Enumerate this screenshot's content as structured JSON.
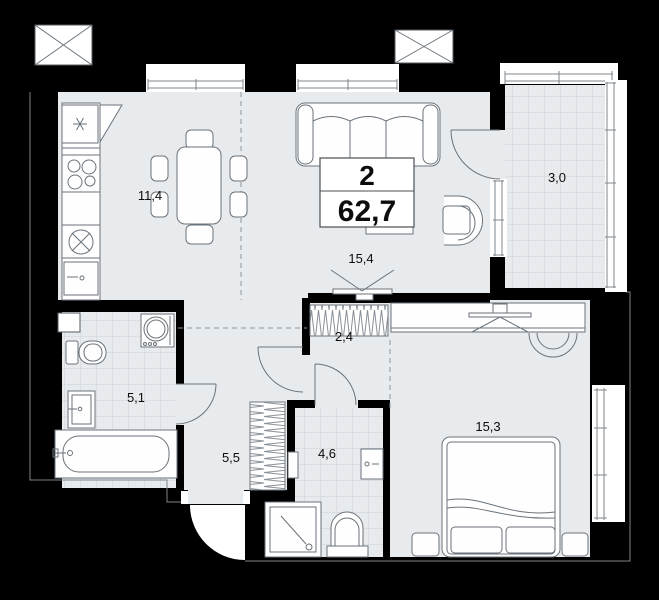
{
  "plan": {
    "title": "apartment-floor-plan",
    "info_box": {
      "rooms": "2",
      "total_area": "62,7"
    },
    "rooms": [
      {
        "id": "kitchen",
        "area": "11,4"
      },
      {
        "id": "living-room",
        "area": "15,4"
      },
      {
        "id": "balcony",
        "area": "3,0"
      },
      {
        "id": "wardrobe-niche",
        "area": "2,4"
      },
      {
        "id": "bathroom",
        "area": "5,1"
      },
      {
        "id": "hallway",
        "area": "5,5"
      },
      {
        "id": "shower-room",
        "area": "4,6"
      },
      {
        "id": "bedroom",
        "area": "15,3"
      }
    ],
    "fixtures": [
      "fridge-snowflake-icon",
      "stove-burners",
      "round-sink",
      "kitchen-cabinet",
      "dining-table",
      "chairs",
      "sofa",
      "coffee-table",
      "tv",
      "desk-chair",
      "built-in-wardrobe",
      "hall-wardrobe",
      "double-bed",
      "nightstands",
      "bathtub",
      "toilet",
      "wash-basin",
      "washing-machine",
      "shower-tray",
      "ventilation-shaft",
      "entry-door",
      "interior-doors",
      "windows"
    ],
    "colors": {
      "wall": "#000000",
      "floor": "#e8ebee",
      "fixture_line": "#6a737b",
      "tile_line": "#ccd2d7",
      "text": "#0c0c0c",
      "white": "#ffffff"
    }
  }
}
